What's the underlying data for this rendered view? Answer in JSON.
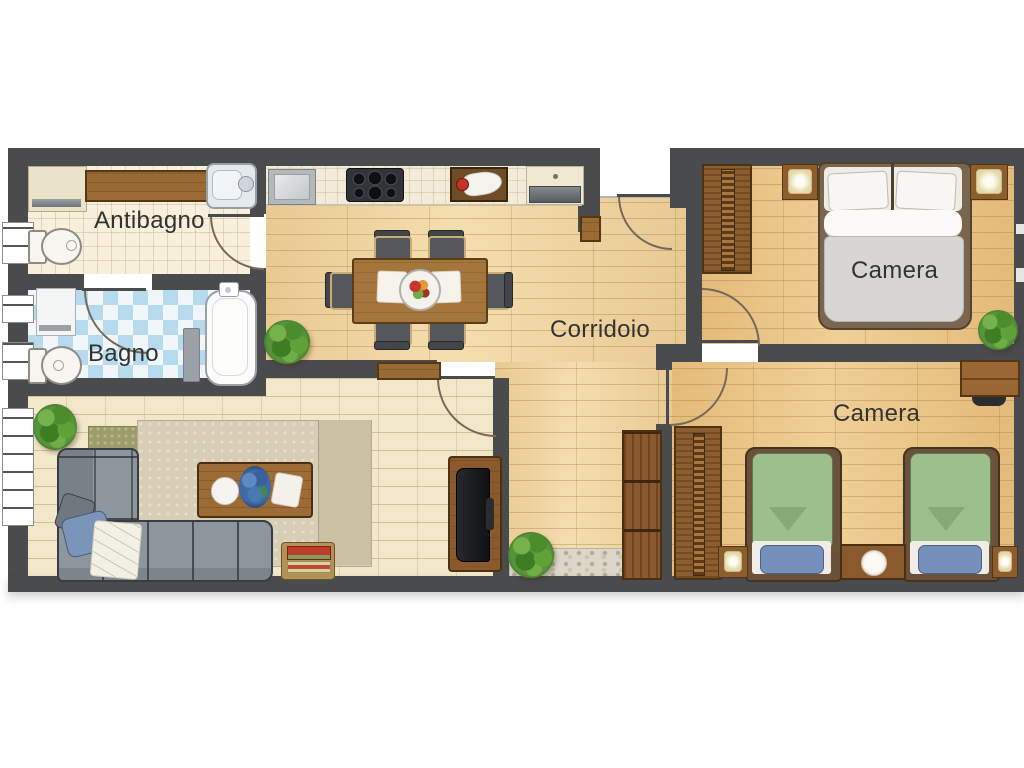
{
  "floorplan": {
    "title": "apartment-floor-plan",
    "rooms": [
      {
        "id": "antibagno",
        "label": "Antibagno"
      },
      {
        "id": "bagno",
        "label": "Bagno"
      },
      {
        "id": "corridoio",
        "label": "Corridoio"
      },
      {
        "id": "camera-matrimoniale",
        "label": "Camera"
      },
      {
        "id": "camera-doppia",
        "label": "Camera"
      }
    ],
    "colors": {
      "wall": "#4a4b4d",
      "wood_floor": "#eccd97",
      "living_tiles": "#f3e7c9",
      "bath_checker_blue": "#b7dbee",
      "rug_beige": "#d8cdb5",
      "rug_green": "#9d9d6b",
      "sofa_gray": "#8d959d",
      "duvet_gray": "#d7d6d3",
      "duvet_green": "#9cc08c",
      "pillow_blue": "#7a95b7",
      "furniture_wood": "#8c5d2f",
      "label_text": "#333333"
    },
    "furniture": {
      "antibagno": [
        "cabinet",
        "wood-counter",
        "sink",
        "toilet",
        "window"
      ],
      "bagno": [
        "washing-machine",
        "toilet",
        "shower-tub",
        "bath-mat",
        "windows"
      ],
      "kitchen_dining": [
        "kitchen-counter",
        "sink-unit",
        "cooktop",
        "cutting-board",
        "base-cabinet",
        "dining-table",
        "six-chairs",
        "fruit-plate",
        "plant"
      ],
      "living": [
        "corner-sofa",
        "coffee-table",
        "side-table",
        "books",
        "tv",
        "rugs",
        "plants",
        "window"
      ],
      "corridoio": [
        "entrance-door",
        "cabinet",
        "plant",
        "gravel-strip"
      ],
      "camera_matrimoniale": [
        "double-bed",
        "two-nightstands",
        "wardrobe",
        "plant"
      ],
      "camera_doppia": [
        "two-single-beds",
        "nightstands",
        "wardrobes",
        "desk",
        "chair"
      ]
    }
  }
}
